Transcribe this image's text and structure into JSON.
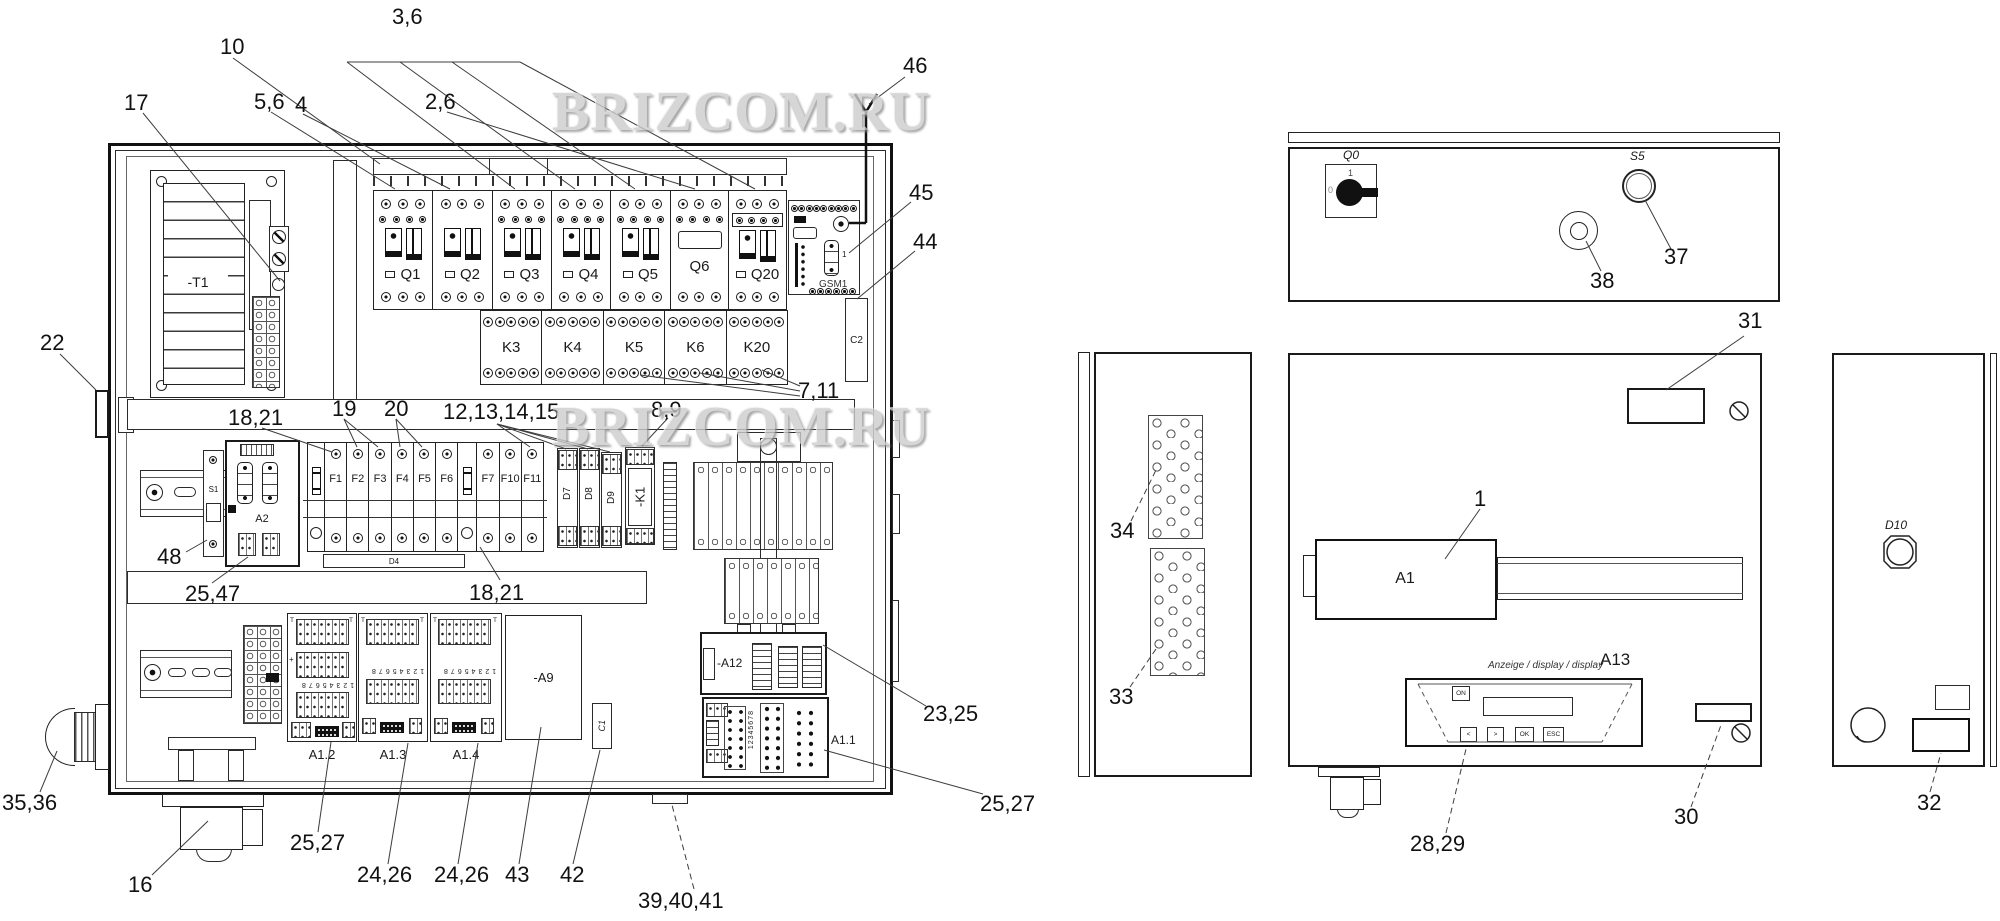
{
  "watermark": {
    "text": "BRIZCOM.RU"
  },
  "callouts": {
    "k17": "17",
    "k10": "10",
    "k56": "5,6",
    "k4": "4",
    "k36": "3,6",
    "k26": "2,6",
    "k46": "46",
    "k45": "45",
    "k44": "44",
    "k22": "22",
    "k711": "7,11",
    "k1821a": "18,21",
    "k19": "19",
    "k20": "20",
    "k1215": "12,13,14,15",
    "k89": "8,9",
    "k48": "48",
    "k2547": "25,47",
    "k1821b": "18,21",
    "k3536": "35,36",
    "k16": "16",
    "k2527a": "25,27",
    "k2426a": "24,26",
    "k2426b": "24,26",
    "k43": "43",
    "k42": "42",
    "k394041": "39,40,41",
    "k2325": "23,25",
    "k2527b": "25,27",
    "k31": "31",
    "k37": "37",
    "k38": "38",
    "k34": "34",
    "k33": "33",
    "k1": "1",
    "k2829": "28,29",
    "k30": "30",
    "k32": "32"
  },
  "cabinet": {
    "transformer": "-T1",
    "breakers": [
      "Q1",
      "Q2",
      "Q3",
      "Q4",
      "Q5",
      "Q6",
      "Q20"
    ],
    "relays": [
      "K3",
      "K4",
      "K5",
      "K6",
      "K20"
    ],
    "gsm": {
      "label": "GSM1",
      "port": "1"
    },
    "c2": "C2",
    "s1": "S1",
    "a2": "A2",
    "fuses": [
      "F1",
      "F2",
      "F3",
      "F4",
      "F5",
      "F6",
      "F7",
      "F10",
      "F11"
    ],
    "d4": "D4",
    "d_modules": [
      "D7",
      "D8",
      "D9"
    ],
    "k1": "-K1",
    "io_modules": [
      "A1.2",
      "A1.3",
      "A1.4"
    ],
    "a9": "-A9",
    "c1": "C1",
    "a12": "-A12",
    "a11": "A1.1",
    "digits": "12345678",
    "t_mark": "T",
    "plus_mark": "+"
  },
  "panels": {
    "top": {
      "q0": "Q0",
      "s5": "S5",
      "q0_on": "1",
      "q0_off": "0"
    },
    "door": {
      "a1": "A1",
      "a13": "A13",
      "caption": "Anzeige / display / display",
      "btn_on": "ON",
      "btn_prev": "<",
      "btn_next": ">",
      "btn_ok": "OK",
      "btn_esc": "ESC"
    },
    "right": {
      "d10": "D10"
    }
  }
}
